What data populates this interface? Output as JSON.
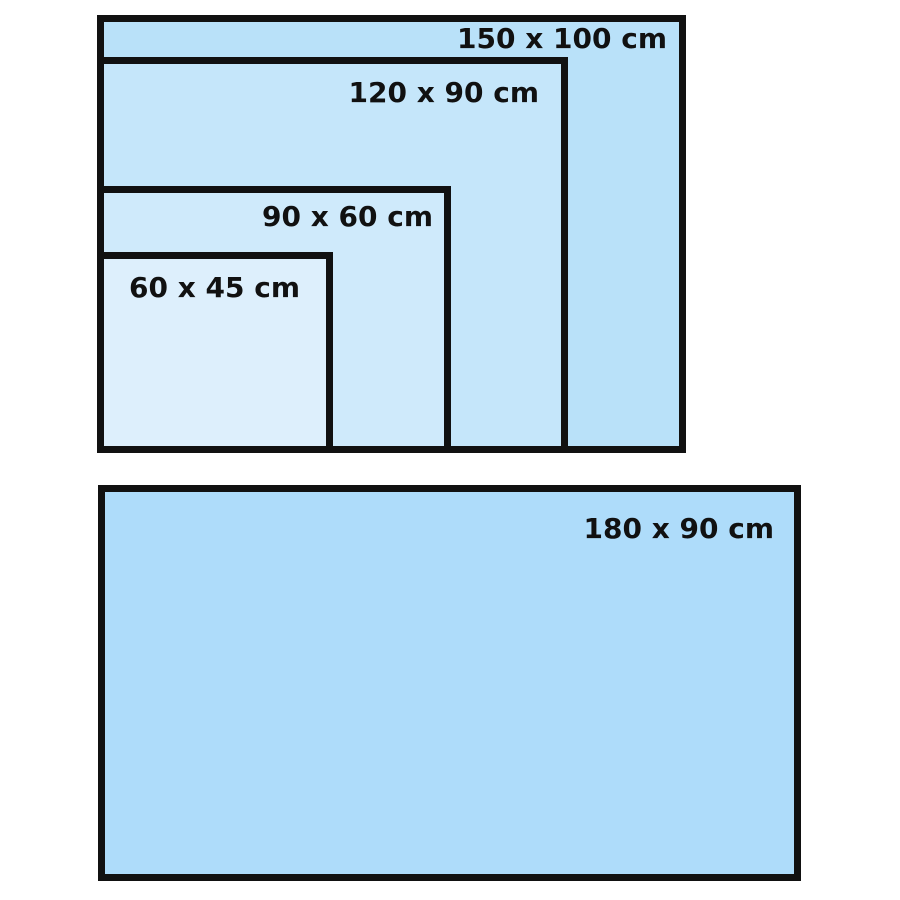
{
  "page": {
    "background_color": "#ffffff",
    "border_color": "#111111",
    "text_color": "#111111"
  },
  "diagram": {
    "description": "Nested rectangles comparing board sizes in centimeters",
    "unit": "cm",
    "sizes": [
      {
        "label": "150 x 100 cm",
        "width_cm": 150,
        "height_cm": 100,
        "fill": "#b9e1f9",
        "group": "nested"
      },
      {
        "label": "120 x 90 cm",
        "width_cm": 120,
        "height_cm": 90,
        "fill": "#c5e6fa",
        "group": "nested"
      },
      {
        "label": "90 x 60 cm",
        "width_cm": 90,
        "height_cm": 60,
        "fill": "#cfeafb",
        "group": "nested"
      },
      {
        "label": "60 x 45 cm",
        "width_cm": 60,
        "height_cm": 45,
        "fill": "#ddeffc",
        "group": "nested"
      },
      {
        "label": "180 x 90 cm",
        "width_cm": 180,
        "height_cm": 90,
        "fill": "#aedcfa",
        "group": "standalone"
      }
    ]
  }
}
